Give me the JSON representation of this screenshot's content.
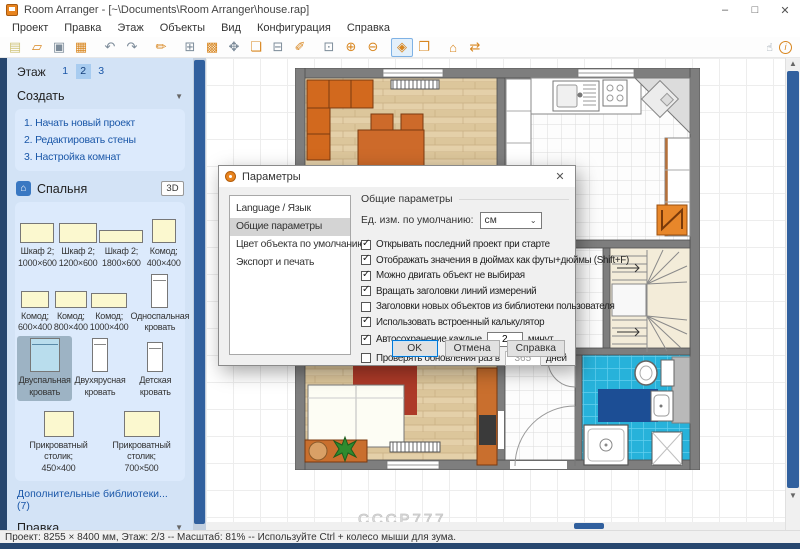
{
  "window": {
    "title": "Room Arranger - [~\\Documents\\Room Arranger\\house.rap]",
    "controls": {
      "minimize": "–",
      "maximize": "□",
      "close": "✕"
    }
  },
  "menu": {
    "items": [
      "Проект",
      "Правка",
      "Этаж",
      "Объекты",
      "Вид",
      "Конфигурация",
      "Справка"
    ]
  },
  "toolbar": {
    "icons": [
      {
        "name": "new-project-icon",
        "glyph": "▤",
        "tone": "cream"
      },
      {
        "name": "open-project-icon",
        "glyph": "▱",
        "tone": "orange"
      },
      {
        "name": "save-icon",
        "glyph": "▣",
        "tone": "gray"
      },
      {
        "name": "print-icon",
        "glyph": "▦",
        "tone": "orange"
      },
      {
        "sep": true
      },
      {
        "name": "undo-icon",
        "glyph": "↶",
        "tone": "gray"
      },
      {
        "name": "redo-icon",
        "glyph": "↷",
        "tone": "gray"
      },
      {
        "sep": true
      },
      {
        "name": "brush-icon",
        "glyph": "✏",
        "tone": "orange"
      },
      {
        "sep": true
      },
      {
        "name": "edit-walls-icon",
        "glyph": "⊞",
        "tone": "gray"
      },
      {
        "name": "coverings-icon",
        "glyph": "▩",
        "tone": "orange"
      },
      {
        "name": "move-object-icon",
        "glyph": "✥",
        "tone": "gray"
      },
      {
        "name": "add-object-icon",
        "glyph": "❏",
        "tone": "orange"
      },
      {
        "name": "add-furniture-icon",
        "glyph": "⊟",
        "tone": "gray"
      },
      {
        "name": "draw-wall-icon",
        "glyph": "✐",
        "tone": "orange"
      },
      {
        "sep": true
      },
      {
        "name": "zoom-window-icon",
        "glyph": "⊡",
        "tone": "gray"
      },
      {
        "name": "zoom-in-icon",
        "glyph": "⊕",
        "tone": "orange"
      },
      {
        "name": "zoom-out-icon",
        "glyph": "⊖",
        "tone": "orange"
      },
      {
        "sep": true
      },
      {
        "name": "view-3d-icon",
        "glyph": "◈",
        "tone": "orange",
        "active": true
      },
      {
        "name": "view-3d-objects-icon",
        "glyph": "❐",
        "tone": "orange"
      },
      {
        "sep": true
      },
      {
        "name": "levels-icon",
        "glyph": "⌂",
        "tone": "orange"
      },
      {
        "name": "share-icon",
        "glyph": "⇄",
        "tone": "orange"
      }
    ],
    "hand_tool_glyph": "☝",
    "info_glyph": "i"
  },
  "sidebar": {
    "floor_label": "Этаж",
    "floors": [
      "1",
      "2",
      "3"
    ],
    "selected_floor": "2",
    "create": {
      "title": "Создать",
      "caret": "▼",
      "links": [
        "1. Начать новый проект",
        "2. Редактировать стены",
        "3. Настройка комнат"
      ]
    },
    "library": {
      "title": "Спальня",
      "icon": "⌂",
      "view3d_label": "3D",
      "rows": [
        [
          {
            "l1": "Шкаф 2;",
            "l2": "1000×600",
            "kind": "cab",
            "w": 34,
            "h": 20
          },
          {
            "l1": "Шкаф 2;",
            "l2": "1200×600",
            "kind": "cab",
            "w": 38,
            "h": 20
          },
          {
            "l1": "Шкаф 2;",
            "l2": "1800×600",
            "kind": "cab",
            "w": 44,
            "h": 13
          },
          {
            "l1": "Комод;",
            "l2": "400×400",
            "kind": "cab",
            "w": 24,
            "h": 24
          }
        ],
        [
          {
            "l1": "Комод;",
            "l2": "600×400",
            "kind": "cab",
            "w": 28,
            "h": 17
          },
          {
            "l1": "Комод;",
            "l2": "800×400",
            "kind": "cab",
            "w": 32,
            "h": 17
          },
          {
            "l1": "Комод;",
            "l2": "1000×400",
            "kind": "cab",
            "w": 36,
            "h": 15
          },
          {
            "l1": "Односпальная",
            "l2": "кровать",
            "kind": "bed",
            "w": 17,
            "h": 34
          }
        ],
        [
          {
            "l1": "Двуспальная",
            "l2": "кровать",
            "kind": "bedsel",
            "w": 30,
            "h": 34,
            "selected": true
          },
          {
            "l1": "Двухярусная",
            "l2": "кровать",
            "kind": "bed",
            "w": 16,
            "h": 34
          },
          {
            "l1": "Детская",
            "l2": "кровать",
            "kind": "bed",
            "w": 16,
            "h": 30
          }
        ],
        [
          {
            "l1": "Прикроватный",
            "l2": "столик;",
            "l3": "450×400",
            "kind": "cab",
            "w": 30,
            "h": 26
          },
          {
            "l1": "Прикроватный",
            "l2": "столик;",
            "l3": "700×500",
            "kind": "cab",
            "w": 36,
            "h": 26
          }
        ]
      ]
    },
    "more_libraries": "Дополнительные библиотеки... (7)",
    "edit_section": {
      "title": "Правка",
      "caret": "▼"
    }
  },
  "dialog": {
    "title": "Параметры",
    "close": "✕",
    "tabs": [
      "Language / Язык",
      "Общие параметры",
      "Цвет объекта по умолчанию",
      "Экспорт и печать"
    ],
    "selected_tab_index": 1,
    "group_title": "Общие параметры",
    "unit_label": "Ед. изм. по умолчанию:",
    "unit_value": "см",
    "checkboxes": [
      {
        "label": "Открывать последний проект при старте",
        "checked": true
      },
      {
        "label": "Отображать значения в дюймах как футы+дюймы (Shift+F)",
        "checked": true
      },
      {
        "label": "Можно двигать объект не выбирая",
        "checked": true
      },
      {
        "label": "Вращать заголовки линий измерений",
        "checked": true
      },
      {
        "label": "Заголовки новых объектов из библиотеки пользователя",
        "checked": false
      },
      {
        "label": "Использовать встроенный калькулятор",
        "checked": true
      }
    ],
    "autosave": {
      "label": "Автосохранение каждые",
      "value": "2",
      "suffix": "минут",
      "checked": true
    },
    "updates": {
      "label": "Проверять обновления раз в",
      "value": "365",
      "suffix": "дней",
      "checked": false
    },
    "buttons": [
      "OK",
      "Отмена",
      "Справка"
    ]
  },
  "canvas": {
    "watermark": "CCCP777"
  },
  "statusbar": {
    "text": "Проект: 8255 × 8400 мм, Этаж: 2/3 -- Масштаб: 81% -- Используйте Ctrl + колесо мыши для зума."
  }
}
